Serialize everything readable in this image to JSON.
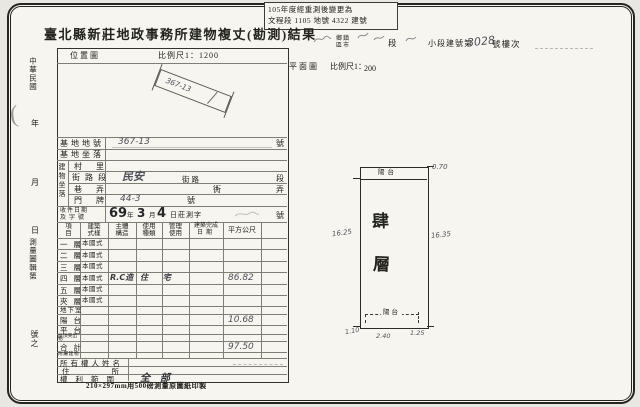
{
  "stamp": {
    "line1": "105年度經重測後變更為",
    "line2": "文程段 1105 地號 4322 建號"
  },
  "title": "臺北縣新莊地政事務所建物複丈(勘測)結果",
  "header_right": {
    "township_top": "鄉鎮",
    "township_bot": "區市",
    "duan": "段",
    "xiaoduan_label": "小段建號第",
    "building_no": "3028",
    "suffix": "號樓次"
  },
  "plan_header": {
    "label": "平面圖",
    "scale_label": "比例尺1：",
    "scale_value": "200"
  },
  "location_map": {
    "label": "位置圖",
    "scale": "比例尺1：1200",
    "parcel": "367-13"
  },
  "left_margin": {
    "era": "中華民國",
    "year": "年",
    "month": "月",
    "day": "日",
    "map_ref": "測量圖輯第",
    "no_suffix": "號之",
    "paren": "("
  },
  "form": {
    "base_no_label": "基地地號",
    "base_no_value": "367-13",
    "base_no_unit": "號",
    "base_loc_label": "基地坐落",
    "group_label": "建物坐落",
    "village_label": "村里",
    "street_label": "街路段",
    "street_value": "民安",
    "street_unit1": "街路",
    "street_unit2": "段",
    "lane_label": "巷弄",
    "lane_unit1": "衖",
    "lane_unit2": "弄",
    "door_label": "門牌",
    "door_value": "44-3",
    "door_unit": "號",
    "receipt_label1": "收件日期",
    "receipt_label2": "及字號",
    "receipt_year": "69",
    "receipt_nian": "年",
    "receipt_month": "3",
    "receipt_yue": "月",
    "receipt_day": "4",
    "receipt_rest": "日莊測字",
    "receipt_unit": "號",
    "headers": [
      {
        "top": "項",
        "bot": "目"
      },
      {
        "top": "建築",
        "bot": "式樣"
      },
      {
        "top": "主體",
        "bot": "構造"
      },
      {
        "top": "使用",
        "bot": "種類"
      },
      {
        "top": "管理",
        "bot": "使用"
      },
      {
        "top": "建築完成",
        "bot": "日期"
      },
      {
        "top": "平方公尺",
        "bot": ""
      }
    ],
    "floors": [
      {
        "label": "一層",
        "style": "本國式",
        "structure": "",
        "use": "",
        "area": ""
      },
      {
        "label": "二層",
        "style": "本國式",
        "structure": "",
        "use": "",
        "area": ""
      },
      {
        "label": "三層",
        "style": "本國式",
        "structure": "",
        "use": "",
        "area": ""
      },
      {
        "label": "四層",
        "style": "本國式",
        "structure": "R.C造",
        "use": "住 宅",
        "area": "86.82"
      },
      {
        "label": "五層",
        "style": "本國式",
        "structure": "",
        "use": "",
        "area": ""
      },
      {
        "label": "夾層",
        "style": "本國式",
        "structure": "",
        "use": "",
        "area": ""
      },
      {
        "label": "地下室",
        "style": "",
        "structure": "",
        "use": "",
        "area": ""
      },
      {
        "label": "陽台",
        "style": "",
        "structure": "",
        "use": "",
        "area": "10.68"
      },
      {
        "label": "平台",
        "style": "",
        "structure": "",
        "use": "",
        "area": ""
      }
    ],
    "roof_label": "屋頂突出物",
    "total_label": "合計",
    "total_value": "97.50",
    "annex_label": "附屬建物",
    "owner_label": "所有權人姓名",
    "address_label": "住所",
    "rights_label": "權利範圍",
    "rights_value": "全　部"
  },
  "floor_plan": {
    "balcony_top": "陽台",
    "balcony_bottom": "陽台",
    "floor_char1": "肆",
    "floor_char2": "層",
    "dim_top": "0.70",
    "dim_left": "16.25",
    "dim_right": "16.35",
    "dim_bottom_left": "1.10",
    "dim_bottom_mid": "2.40",
    "dim_bottom_right": "1.25"
  },
  "footer_note": "210×297mm用500磅測量原圖紙印製"
}
